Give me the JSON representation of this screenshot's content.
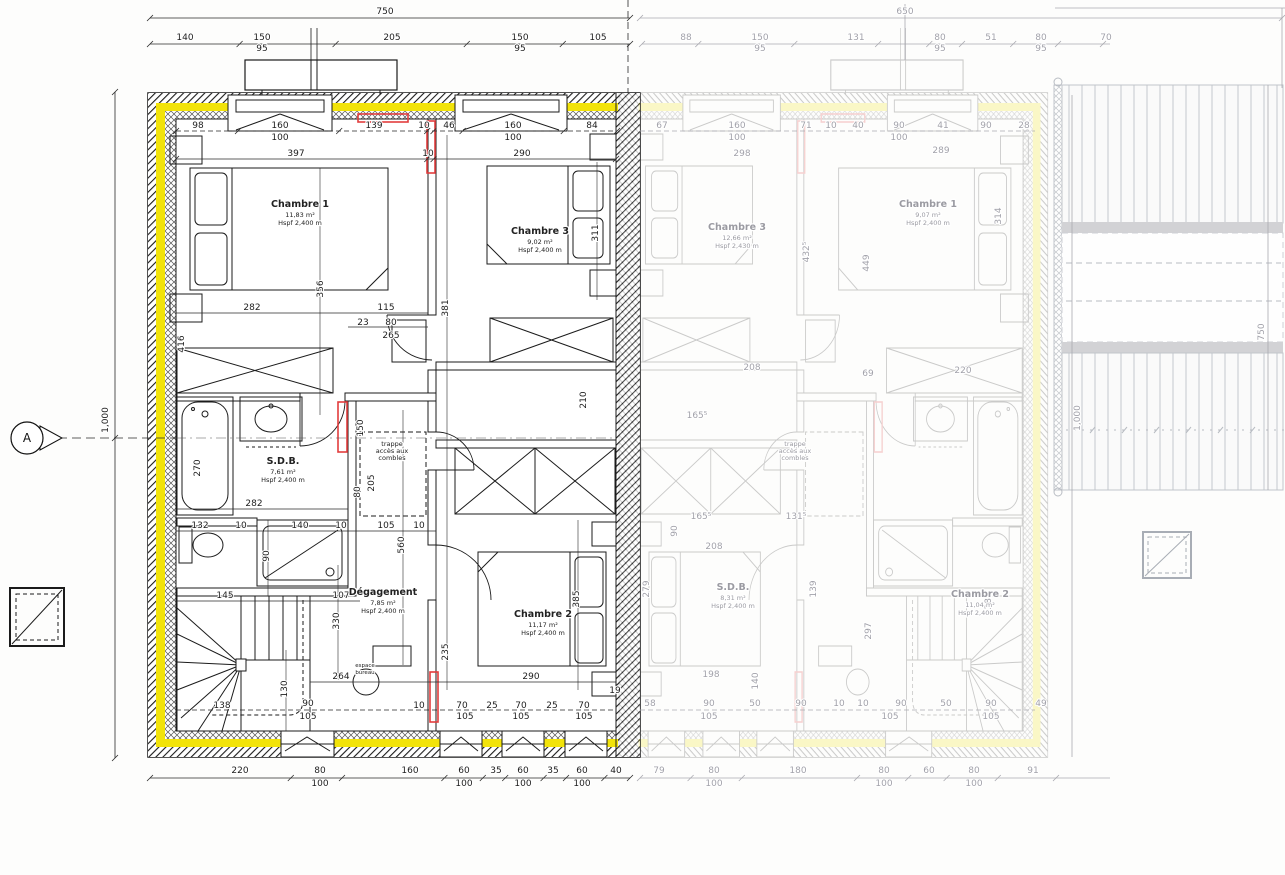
{
  "drawing": {
    "type": "floor-plan",
    "level": "étage (combles aménagés)",
    "colors": {
      "insulation_yellow": "#f2e30a",
      "accent_red": "#e23d3d",
      "line_dark": "#1a1a1a",
      "faded_gray": "#a2a2aa"
    }
  },
  "legend": {
    "section_marker": "A"
  },
  "rooms": [
    {
      "id": "chambre-1",
      "lines": [
        "Chambre 1",
        "11,83 m²",
        "Hspf 2,400 m"
      ],
      "x": 300,
      "y": 207
    },
    {
      "id": "chambre-3",
      "lines": [
        "Chambre 3",
        "9,02 m²",
        "Hspf 2,400 m"
      ],
      "x": 540,
      "y": 234
    },
    {
      "id": "sdb",
      "lines": [
        "S.D.B.",
        "7,61 m²",
        "Hspf 2,400 m"
      ],
      "x": 283,
      "y": 464
    },
    {
      "id": "degagement",
      "lines": [
        "Dégagement",
        "7,85 m²",
        "Hspf 2,400 m"
      ],
      "x": 383,
      "y": 595
    },
    {
      "id": "chambre-2",
      "lines": [
        "Chambre 2",
        "11,17 m²",
        "Hspf 2,400 m"
      ],
      "x": 543,
      "y": 617
    },
    {
      "id": "trappe-combles",
      "lines": [
        "trappe",
        "accès aux",
        "combles"
      ],
      "x": 392,
      "y": 446,
      "s": 1
    },
    {
      "id": "chambre-3-right",
      "lines": [
        "Chambre 3",
        "12,66 m²",
        "Hspf 2,430 m"
      ],
      "x": 737,
      "y": 230,
      "f": 1
    },
    {
      "id": "chambre-1-right",
      "lines": [
        "Chambre 1",
        "9,07 m²",
        "Hspf 2,400 m"
      ],
      "x": 928,
      "y": 207,
      "f": 1
    },
    {
      "id": "sdb-right",
      "lines": [
        "S.D.B.",
        "8,31 m²",
        "Hspf 2,400 m"
      ],
      "x": 733,
      "y": 590,
      "f": 1
    },
    {
      "id": "chambre-2-right",
      "lines": [
        "Chambre 2",
        "11,04 m²",
        "Hspf 2,400 m"
      ],
      "x": 980,
      "y": 597,
      "f": 1
    },
    {
      "id": "trappe-combles-right",
      "lines": [
        "trappe",
        "accès aux",
        "combles"
      ],
      "x": 795,
      "y": 446,
      "f": 1,
      "s": 1
    }
  ],
  "dim_labels": [
    {
      "t": "750",
      "x": 385,
      "y": 14
    },
    {
      "t": "140",
      "x": 185,
      "y": 40
    },
    {
      "t": "150",
      "x": 262,
      "y": 40
    },
    {
      "t": "95",
      "x": 262,
      "y": 51
    },
    {
      "t": "205",
      "x": 392,
      "y": 40
    },
    {
      "t": "150",
      "x": 520,
      "y": 40
    },
    {
      "t": "95",
      "x": 520,
      "y": 51
    },
    {
      "t": "105",
      "x": 598,
      "y": 40
    },
    {
      "t": "98",
      "x": 198,
      "y": 128
    },
    {
      "t": "160",
      "x": 280,
      "y": 128
    },
    {
      "t": "100",
      "x": 280,
      "y": 140
    },
    {
      "t": "139",
      "x": 374,
      "y": 128
    },
    {
      "t": "10",
      "x": 424,
      "y": 128
    },
    {
      "t": "46",
      "x": 449,
      "y": 128
    },
    {
      "t": "160",
      "x": 513,
      "y": 128
    },
    {
      "t": "100",
      "x": 513,
      "y": 140
    },
    {
      "t": "84",
      "x": 592,
      "y": 128
    },
    {
      "t": "397",
      "x": 296,
      "y": 156
    },
    {
      "t": "10",
      "x": 428,
      "y": 156
    },
    {
      "t": "290",
      "x": 522,
      "y": 156
    },
    {
      "t": "416",
      "x": 184,
      "y": 344,
      "r": 1
    },
    {
      "t": "356",
      "x": 323,
      "y": 289,
      "r": 1
    },
    {
      "t": "381",
      "x": 448,
      "y": 308,
      "r": 1
    },
    {
      "t": "311",
      "x": 598,
      "y": 233,
      "r": 1
    },
    {
      "t": "282",
      "x": 252,
      "y": 310
    },
    {
      "t": "115",
      "x": 386,
      "y": 310
    },
    {
      "t": "23",
      "x": 363,
      "y": 325
    },
    {
      "t": "80",
      "x": 391,
      "y": 325
    },
    {
      "t": "265",
      "x": 391,
      "y": 338
    },
    {
      "t": "270",
      "x": 200,
      "y": 468,
      "r": 1
    },
    {
      "t": "150",
      "x": 363,
      "y": 428,
      "r": 1
    },
    {
      "t": "205",
      "x": 374,
      "y": 483,
      "r": 1
    },
    {
      "t": "80",
      "x": 360,
      "y": 492,
      "r": 1
    },
    {
      "t": "210",
      "x": 586,
      "y": 400,
      "r": 1
    },
    {
      "t": "282",
      "x": 254,
      "y": 506
    },
    {
      "t": "132",
      "x": 200,
      "y": 528
    },
    {
      "t": "10",
      "x": 241,
      "y": 528
    },
    {
      "t": "140",
      "x": 300,
      "y": 528
    },
    {
      "t": "10",
      "x": 341,
      "y": 528
    },
    {
      "t": "105",
      "x": 386,
      "y": 528
    },
    {
      "t": "10",
      "x": 419,
      "y": 528
    },
    {
      "t": "90",
      "x": 269,
      "y": 556,
      "r": 1
    },
    {
      "t": "560",
      "x": 404,
      "y": 545,
      "r": 1
    },
    {
      "t": "145",
      "x": 225,
      "y": 598
    },
    {
      "t": "107",
      "x": 341,
      "y": 598
    },
    {
      "t": "330",
      "x": 339,
      "y": 621,
      "r": 1
    },
    {
      "t": "235",
      "x": 448,
      "y": 652,
      "r": 1
    },
    {
      "t": "385",
      "x": 579,
      "y": 599,
      "r": 1
    },
    {
      "t": "264",
      "x": 341,
      "y": 679
    },
    {
      "t": "290",
      "x": 531,
      "y": 679
    },
    {
      "t": "130",
      "x": 287,
      "y": 689,
      "r": 1
    },
    {
      "t": "19",
      "x": 615,
      "y": 693
    },
    {
      "t": "138",
      "x": 222,
      "y": 708
    },
    {
      "t": "90",
      "x": 308,
      "y": 706
    },
    {
      "t": "105",
      "x": 308,
      "y": 719
    },
    {
      "t": "10",
      "x": 419,
      "y": 708
    },
    {
      "t": "70",
      "x": 462,
      "y": 708
    },
    {
      "t": "25",
      "x": 492,
      "y": 708
    },
    {
      "t": "70",
      "x": 521,
      "y": 708
    },
    {
      "t": "25",
      "x": 552,
      "y": 708
    },
    {
      "t": "70",
      "x": 584,
      "y": 708
    },
    {
      "t": "105",
      "x": 465,
      "y": 719
    },
    {
      "t": "105",
      "x": 521,
      "y": 719
    },
    {
      "t": "105",
      "x": 584,
      "y": 719
    },
    {
      "t": "220",
      "x": 240,
      "y": 773
    },
    {
      "t": "80",
      "x": 320,
      "y": 773
    },
    {
      "t": "100",
      "x": 320,
      "y": 786
    },
    {
      "t": "160",
      "x": 410,
      "y": 773
    },
    {
      "t": "60",
      "x": 464,
      "y": 773
    },
    {
      "t": "100",
      "x": 464,
      "y": 786
    },
    {
      "t": "35",
      "x": 496,
      "y": 773
    },
    {
      "t": "60",
      "x": 523,
      "y": 773
    },
    {
      "t": "100",
      "x": 523,
      "y": 786
    },
    {
      "t": "35",
      "x": 553,
      "y": 773
    },
    {
      "t": "60",
      "x": 582,
      "y": 773
    },
    {
      "t": "100",
      "x": 582,
      "y": 786
    },
    {
      "t": "40",
      "x": 616,
      "y": 773
    },
    {
      "t": "1,000",
      "x": 108,
      "y": 420,
      "r": 1
    },
    {
      "t": "espace",
      "x": 365,
      "y": 667,
      "s": 1
    },
    {
      "t": "bureau",
      "x": 365,
      "y": 674,
      "s": 1
    },
    {
      "t": "650",
      "x": 905,
      "y": 14,
      "f": 1
    },
    {
      "t": "88",
      "x": 686,
      "y": 40,
      "f": 1
    },
    {
      "t": "150",
      "x": 760,
      "y": 40,
      "f": 1
    },
    {
      "t": "95",
      "x": 760,
      "y": 51,
      "f": 1
    },
    {
      "t": "131",
      "x": 856,
      "y": 40,
      "f": 1
    },
    {
      "t": "80",
      "x": 940,
      "y": 40,
      "f": 1
    },
    {
      "t": "95",
      "x": 940,
      "y": 51,
      "f": 1
    },
    {
      "t": "51",
      "x": 991,
      "y": 40,
      "f": 1
    },
    {
      "t": "80",
      "x": 1041,
      "y": 40,
      "f": 1
    },
    {
      "t": "95",
      "x": 1041,
      "y": 51,
      "f": 1
    },
    {
      "t": "70",
      "x": 1106,
      "y": 40,
      "f": 1
    },
    {
      "t": "67",
      "x": 662,
      "y": 128,
      "f": 1
    },
    {
      "t": "160",
      "x": 737,
      "y": 128,
      "f": 1
    },
    {
      "t": "100",
      "x": 737,
      "y": 140,
      "f": 1
    },
    {
      "t": "71",
      "x": 806,
      "y": 128,
      "f": 1
    },
    {
      "t": "10",
      "x": 831,
      "y": 128,
      "f": 1
    },
    {
      "t": "40",
      "x": 858,
      "y": 128,
      "f": 1
    },
    {
      "t": "90",
      "x": 899,
      "y": 128,
      "f": 1
    },
    {
      "t": "100",
      "x": 899,
      "y": 140,
      "f": 1
    },
    {
      "t": "41",
      "x": 943,
      "y": 128,
      "f": 1
    },
    {
      "t": "90",
      "x": 986,
      "y": 128,
      "f": 1
    },
    {
      "t": "28",
      "x": 1024,
      "y": 128,
      "f": 1
    },
    {
      "t": "298",
      "x": 742,
      "y": 156,
      "f": 1
    },
    {
      "t": "289",
      "x": 941,
      "y": 153,
      "f": 1
    },
    {
      "t": "432⁵",
      "x": 809,
      "y": 252,
      "f": 1,
      "r": 1
    },
    {
      "t": "449",
      "x": 869,
      "y": 263,
      "f": 1,
      "r": 1
    },
    {
      "t": "314",
      "x": 1001,
      "y": 216,
      "f": 1,
      "r": 1
    },
    {
      "t": "69",
      "x": 868,
      "y": 376,
      "f": 1
    },
    {
      "t": "220",
      "x": 963,
      "y": 373,
      "f": 1
    },
    {
      "t": "208",
      "x": 752,
      "y": 370,
      "f": 1
    },
    {
      "t": "165⁵",
      "x": 697,
      "y": 418,
      "f": 1
    },
    {
      "t": "165⁵",
      "x": 701,
      "y": 519,
      "f": 1
    },
    {
      "t": "208",
      "x": 714,
      "y": 549,
      "f": 1
    },
    {
      "t": "131⁵",
      "x": 796,
      "y": 519,
      "f": 1
    },
    {
      "t": "90",
      "x": 677,
      "y": 531,
      "f": 1,
      "r": 1
    },
    {
      "t": "279",
      "x": 649,
      "y": 589,
      "f": 1,
      "r": 1
    },
    {
      "t": "139",
      "x": 816,
      "y": 589,
      "f": 1,
      "r": 1
    },
    {
      "t": "297",
      "x": 871,
      "y": 631,
      "f": 1,
      "r": 1
    },
    {
      "t": "382",
      "x": 991,
      "y": 601,
      "f": 1,
      "r": 1
    },
    {
      "t": "198",
      "x": 711,
      "y": 677,
      "f": 1
    },
    {
      "t": "140",
      "x": 758,
      "y": 681,
      "f": 1,
      "r": 1
    },
    {
      "t": "58",
      "x": 650,
      "y": 706,
      "f": 1
    },
    {
      "t": "90",
      "x": 709,
      "y": 706,
      "f": 1
    },
    {
      "t": "105",
      "x": 709,
      "y": 719,
      "f": 1
    },
    {
      "t": "50",
      "x": 755,
      "y": 706,
      "f": 1
    },
    {
      "t": "90",
      "x": 801,
      "y": 706,
      "f": 1
    },
    {
      "t": "10",
      "x": 839,
      "y": 706,
      "f": 1
    },
    {
      "t": "10",
      "x": 863,
      "y": 706,
      "f": 1
    },
    {
      "t": "90",
      "x": 901,
      "y": 706,
      "f": 1
    },
    {
      "t": "105",
      "x": 890,
      "y": 719,
      "f": 1
    },
    {
      "t": "50",
      "x": 946,
      "y": 706,
      "f": 1
    },
    {
      "t": "90",
      "x": 991,
      "y": 706,
      "f": 1
    },
    {
      "t": "105",
      "x": 991,
      "y": 719,
      "f": 1
    },
    {
      "t": "49",
      "x": 1041,
      "y": 706,
      "f": 1
    },
    {
      "t": "79",
      "x": 659,
      "y": 773,
      "f": 1
    },
    {
      "t": "80",
      "x": 714,
      "y": 773,
      "f": 1
    },
    {
      "t": "100",
      "x": 714,
      "y": 786,
      "f": 1
    },
    {
      "t": "180",
      "x": 798,
      "y": 773,
      "f": 1
    },
    {
      "t": "80",
      "x": 884,
      "y": 773,
      "f": 1
    },
    {
      "t": "100",
      "x": 884,
      "y": 786,
      "f": 1
    },
    {
      "t": "60",
      "x": 929,
      "y": 773,
      "f": 1
    },
    {
      "t": "80",
      "x": 974,
      "y": 773,
      "f": 1
    },
    {
      "t": "100",
      "x": 974,
      "y": 786,
      "f": 1
    },
    {
      "t": "91",
      "x": 1033,
      "y": 773,
      "f": 1
    },
    {
      "t": "1,000",
      "x": 1080,
      "y": 418,
      "f": 1,
      "r": 1
    },
    {
      "t": "750",
      "x": 1264,
      "y": 332,
      "f": 1,
      "r": 1
    }
  ]
}
